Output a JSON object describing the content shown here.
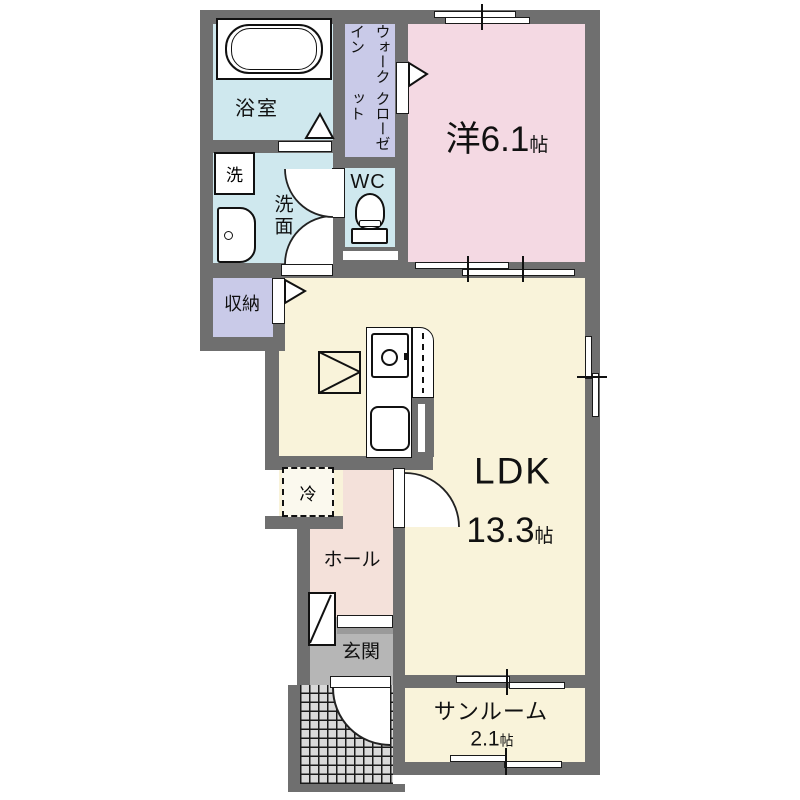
{
  "plan": {
    "type": "floorplan",
    "colors": {
      "wall": "#6f6f6f",
      "wet": "#cfe8ee",
      "closet": "#c9cae8",
      "bedroom": "#f4d9e3",
      "ldk_fill": "#f9f3da",
      "hall_fill": "#f4e1da",
      "entrance_fill": "#b6b6b6",
      "porch_fill": "#d9d9d9"
    },
    "rooms": {
      "bath": {
        "label": "浴室"
      },
      "washer": {
        "label": "洗"
      },
      "washroom": {
        "label": "洗面"
      },
      "wc": {
        "label": "WC"
      },
      "wic": {
        "line1": "ウォークイン",
        "line2": "クローゼット"
      },
      "western": {
        "label": "洋6.1",
        "unit": "帖"
      },
      "storage": {
        "label": "収納"
      },
      "fridge": {
        "label": "冷"
      },
      "ldk": {
        "label": "LDK",
        "size": "13.3",
        "unit": "帖"
      },
      "hall": {
        "label": "ホール"
      },
      "entrance": {
        "label": "玄関"
      },
      "sunroom": {
        "label": "サンルーム",
        "size": "2.1",
        "unit": "帖"
      }
    }
  }
}
